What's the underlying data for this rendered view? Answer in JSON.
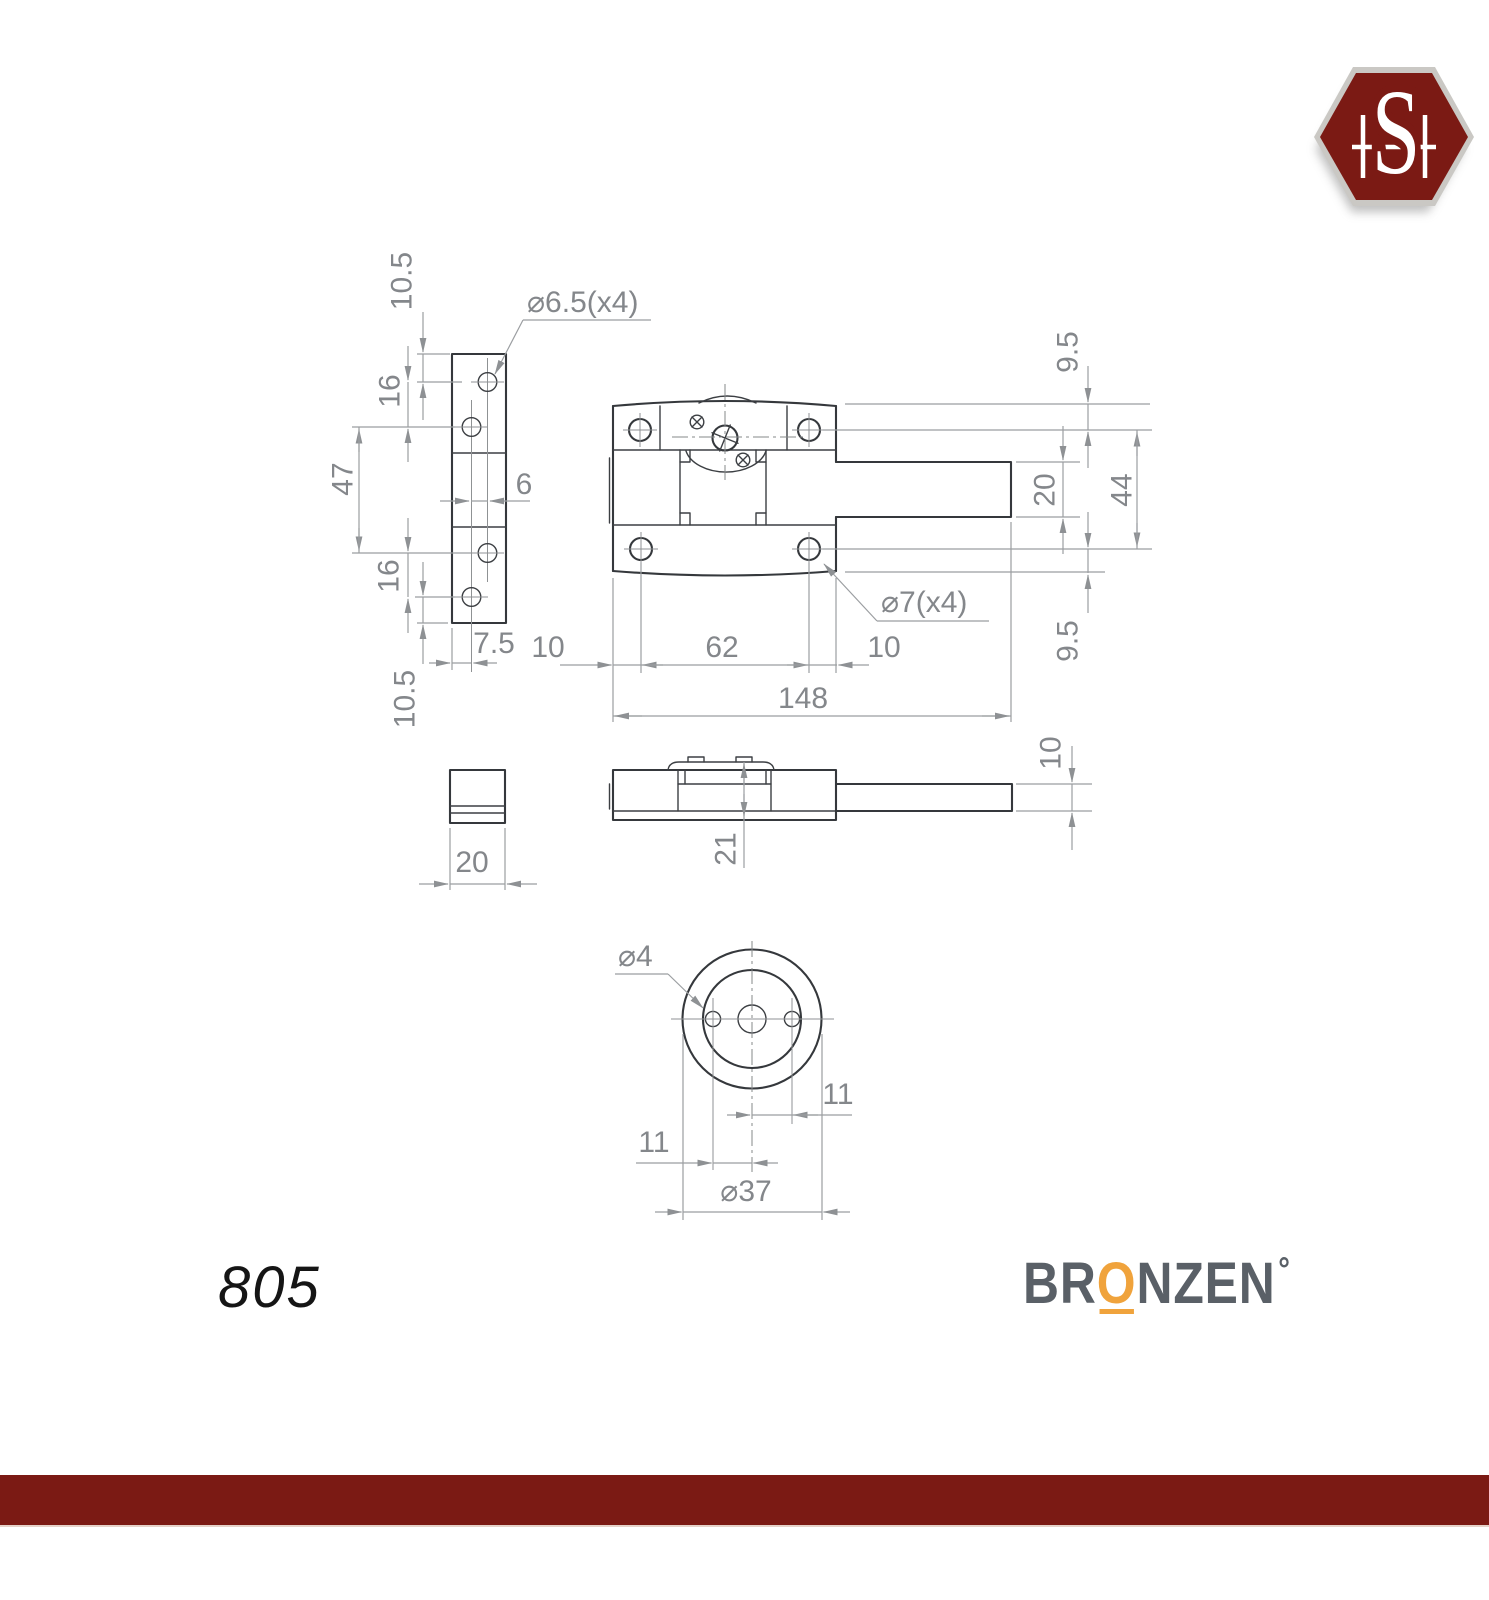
{
  "colors": {
    "maroon": "#7b1a14",
    "orange": "#f0a33c",
    "brand_gray": "#5a6067",
    "part_line": "#35383c",
    "dim_line": "#9b9ea1",
    "dim_text": "#84878b"
  },
  "logo": {
    "monogram": "SH",
    "letter_s": "S"
  },
  "views": {
    "strip": {
      "callout_holes": "⌀6.5(x4)",
      "dims": {
        "top_offset": "10.5",
        "hole_gap_top": "16",
        "hole_span": "47",
        "hole_gap_bottom": "16",
        "bottom_offset": "10.5",
        "hole_stagger": "6",
        "hole_inset": "7.5",
        "thickness": "20"
      }
    },
    "front": {
      "callout_holes": "⌀7(x4)",
      "dims": {
        "edge_to_hole_left": "10",
        "hole_span": "62",
        "edge_to_hole_right": "10",
        "total_length": "148",
        "top_offset": "9.5",
        "bolt_height": "20",
        "hole_row_span": "44",
        "bottom_offset": "9.5"
      }
    },
    "side": {
      "dims": {
        "body_height": "21",
        "bolt_thickness": "10"
      }
    },
    "rosette": {
      "callout_holes": "⌀4",
      "dims": {
        "hole_offset_right": "11",
        "hole_offset_left": "11",
        "diameter": "⌀37"
      }
    }
  },
  "footer": {
    "model_number": "805",
    "brand_pre": "BR",
    "brand_o": "O",
    "brand_post": "NZEN",
    "brand_degree": "°"
  }
}
